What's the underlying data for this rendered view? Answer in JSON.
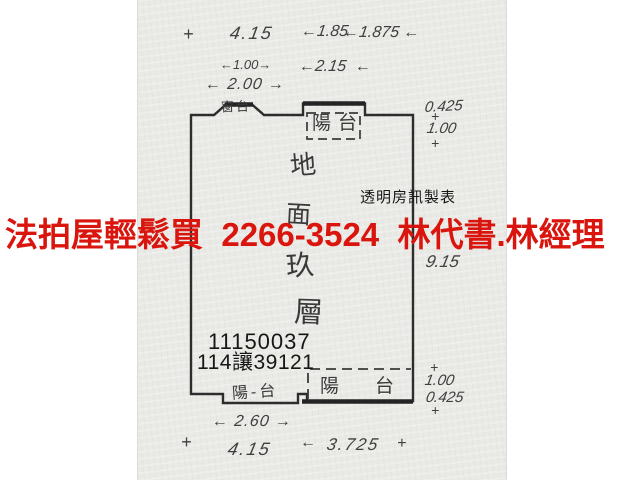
{
  "colors": {
    "ad_red": "#d9150e",
    "paper": "#e9e9e6",
    "ink": "#2d2d2d"
  },
  "ad_banner": {
    "text": "法拍屋輕鬆買  2266-3524  林代書.林經理"
  },
  "publisher": {
    "text": "透明房訊製表"
  },
  "case": {
    "line1": "11150037",
    "line2": "114讓39121"
  },
  "plan": {
    "labels": {
      "window_sill": "窗台",
      "balcony_top": "陽台",
      "balcony_bottom": "陽台",
      "balcony_bottom_left": "陽-台",
      "floor": [
        "地",
        "面",
        "玖",
        "層"
      ]
    },
    "dimensions": {
      "top_a": "4.15",
      "top_b": "←1.85",
      "top_c": "←1.875 ←",
      "mid_a": "←1.00→",
      "mid_b": "←2.15  ←",
      "mid_c": "← 2.00 →",
      "right_top_a": "0.425",
      "right_top_b": "1.00",
      "right_mid": "9.15",
      "right_bot_a": "1.00",
      "right_bot_b": "0.425",
      "bot_a": "← 2.60 →",
      "bot_b": "4.15",
      "bot_c": "3.725"
    },
    "glyphs": {
      "plus": "+",
      "arrow_left": "←",
      "arrow_right": "→"
    }
  }
}
